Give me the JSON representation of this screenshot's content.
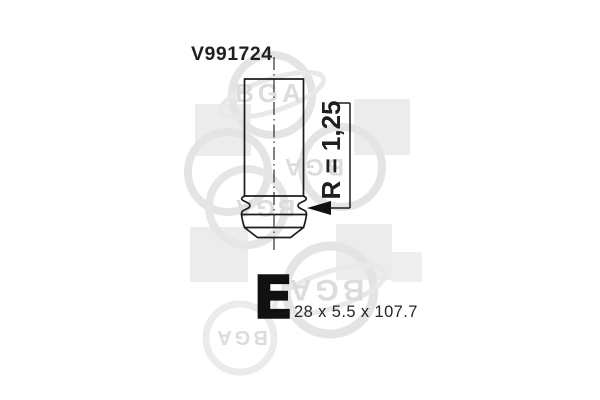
{
  "diagram": {
    "part_number": "V991724",
    "valve_type_letter": "E",
    "size_label": "28 x 5.5 x 107.7",
    "radius_label": "R = 1,25",
    "watermark_brand": "BGA",
    "colors": {
      "background": "#ffffff",
      "line": "#1c1c1c",
      "text": "#1f1f1f",
      "watermark_square": "#ececec",
      "watermark_ring": "#e4e4e4",
      "watermark_text": "#dcdcdc"
    }
  }
}
